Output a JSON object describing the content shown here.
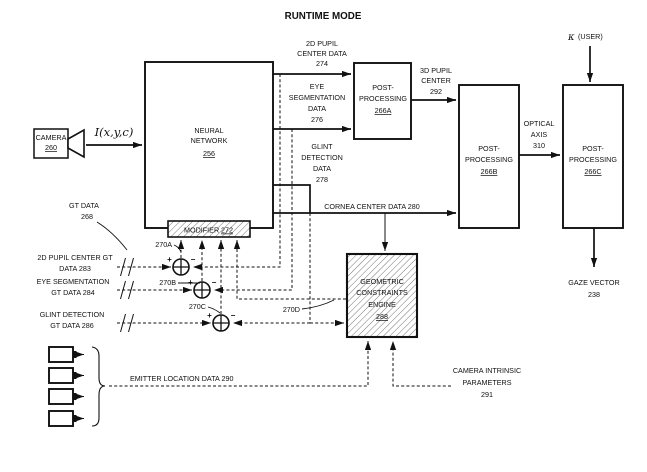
{
  "title": "RUNTIME MODE",
  "colors": {
    "ink": "#111111",
    "paper": "#ffffff"
  },
  "camera": {
    "label": "CAMERA",
    "ref": "260",
    "signal": "I(x,y,c)"
  },
  "blocks": {
    "neural_network": {
      "lines": [
        "NEURAL",
        "NETWORK"
      ],
      "ref": "256"
    },
    "modifier": {
      "label": "MODIFIER",
      "ref": "272"
    },
    "post_a": {
      "lines": [
        "POST-",
        "PROCESSING"
      ],
      "ref": "266A"
    },
    "post_b": {
      "lines": [
        "POST-",
        "PROCESSING"
      ],
      "ref": "266B"
    },
    "post_c": {
      "lines": [
        "POST-",
        "PROCESSING"
      ],
      "ref": "266C"
    },
    "gce": {
      "lines": [
        "GEOMETRIC",
        "CONSTRAINTS",
        "ENGINE"
      ],
      "ref": "288"
    }
  },
  "signals": {
    "pupil2d": {
      "lines": [
        "2D PUPIL",
        "CENTER DATA",
        "274"
      ]
    },
    "eyeseg": {
      "lines": [
        "EYE",
        "SEGMENTATION",
        "DATA",
        "276"
      ]
    },
    "glint": {
      "lines": [
        "GLINT",
        "DETECTION",
        "DATA",
        "278"
      ]
    },
    "cornea": {
      "label": "CORNEA CENTER DATA 280"
    },
    "pupil3d": {
      "lines": [
        "3D PUPIL",
        "CENTER",
        "292"
      ]
    },
    "optical_axis": {
      "lines": [
        "OPTICAL",
        "AXIS",
        "310"
      ]
    },
    "kappa": {
      "sym": "κ",
      "label": "(USER)"
    },
    "gaze": {
      "lines": [
        "GAZE VECTOR",
        "238"
      ]
    },
    "emitter": {
      "label": "EMITTER LOCATION DATA 290"
    },
    "cam_intrinsic": {
      "lines": [
        "CAMERA INTRINSIC",
        "PARAMETERS",
        "291"
      ]
    }
  },
  "gt": {
    "header": {
      "lines": [
        "GT DATA",
        "268"
      ]
    },
    "pupil": {
      "lines": [
        "2D PUPIL CENTER GT",
        "DATA 283"
      ]
    },
    "eyeseg": {
      "lines": [
        "EYE SEGMENTATION",
        "GT DATA 284"
      ]
    },
    "glint": {
      "lines": [
        "GLINT DETECTION",
        "GT DATA 286"
      ]
    }
  },
  "adders": {
    "a": "270A",
    "b": "270B",
    "c": "270C",
    "d": "270D",
    "plus": "+",
    "minus": "−"
  }
}
